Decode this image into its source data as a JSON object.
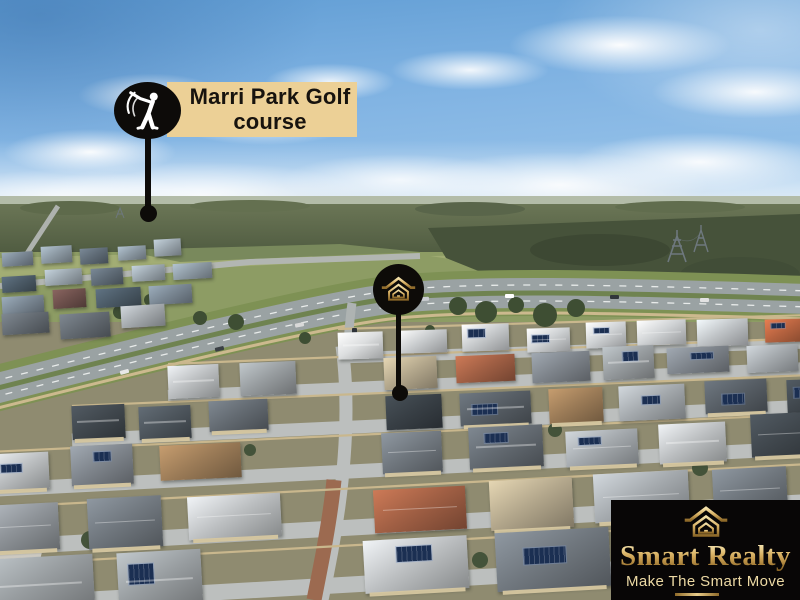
{
  "annotations": {
    "golf_marker": {
      "icon": "golfer-icon",
      "label": {
        "line1": "Marri Park Golf",
        "line2": "course"
      },
      "colors": {
        "badge": "#0d0b09",
        "label_bg": "#ecd096",
        "label_text": "#17130e",
        "icon": "#ffffff"
      }
    },
    "property_marker": {
      "icon": "house-icon",
      "colors": {
        "badge": "#0d0b08",
        "icon_gold": "#d9b66e"
      }
    }
  },
  "brand": {
    "logo_icon": "house-icon",
    "name": "Smart Realty",
    "tagline": "Make The Smart Move",
    "colors": {
      "bg": "#080606",
      "gold_light": "#f6e8b8",
      "gold": "#dcb76a",
      "gold_dark": "#8a6526",
      "tagline": "#ecd9a4"
    }
  },
  "scene": {
    "palette": {
      "sky_top": "#5f9cd3",
      "sky_horizon": "#eef4f8",
      "bush_dark": "#4c583e",
      "bush_light": "#6b7656",
      "field_green": "#8d9c64",
      "highway_gray": "#9aa2a3",
      "highway_verge": "#7e9154",
      "street_gray": "#bcbfbe",
      "brick_street": "#9c6a50",
      "fence_tan": "#c9b78d",
      "wall_tan": "#d6c7a0",
      "solar_blue": "#1b2f52",
      "tree_green": "#3e4e33",
      "roofs_far": [
        "#5f6b76",
        "#7a8793",
        "#4b5a66",
        "#8c99a3",
        "#6c4f4b",
        "#9aa5ad"
      ],
      "roofs_light": [
        "#cfd2d4",
        "#dcdedf",
        "#bfc3c6",
        "#e4e5e5",
        "#b0b5b9",
        "#c8cbcd"
      ],
      "roofs_mid": [
        "#70777e",
        "#575e65",
        "#8e9398",
        "#40474d",
        "#a4a9ad",
        "#7e848b",
        "#bcbfc1",
        "#4d555c",
        "#979c9f",
        "#636a71",
        "#9b7b57",
        "#b3a78c",
        "#a05f44"
      ]
    }
  }
}
